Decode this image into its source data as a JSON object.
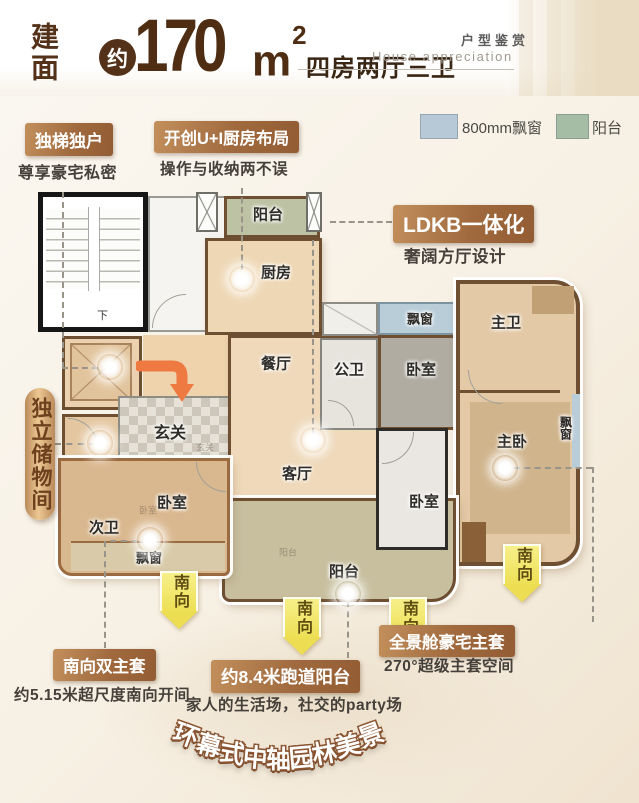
{
  "header": {
    "area_label": "建面",
    "approx": "约",
    "area_value": "170",
    "unit_base": "m",
    "unit_exp": "2",
    "layout_type": "四房两厅三卫",
    "title_cn": "户型鉴赏",
    "title_en": "House appreciation"
  },
  "legend": {
    "bay_window": {
      "label": "800mm飘窗",
      "color": "#b7c9d6"
    },
    "balcony": {
      "label": "阳台",
      "color": "#a6bda5"
    }
  },
  "callouts": {
    "private_elevator": {
      "title": "独梯独户",
      "subtitle": "尊享豪宅私密"
    },
    "kitchen_layout": {
      "title": "开创U+I厨房布局",
      "subtitle": "操作与收纳两不误"
    },
    "ldkb": {
      "title": "LDKB一体化",
      "subtitle": "奢阔方厅设计"
    },
    "storage_ribbon": "独立储物间",
    "south_double_suite": {
      "title": "南向双主套",
      "subtitle": "约5.15米超尺度南向开间"
    },
    "runway_balcony": {
      "title": "约8.4米跑道阳台",
      "subtitle": "家人的生活场，社交的party场"
    },
    "panorama_suite": {
      "title": "全景舱豪宅主套",
      "subtitle": "270°超级主套空间"
    },
    "arc_text": "环幕式中轴园林美景"
  },
  "rooms": {
    "balcony_top": "阳台",
    "kitchen": "厨房",
    "dining": "餐厅",
    "living": "客厅",
    "foyer": "玄关",
    "foyer_small": "玄关",
    "public_bath": "公卫",
    "bay_mid": "飘窗",
    "bedroom_north": "卧室",
    "master_bath": "主卫",
    "master_bedroom": "主卧",
    "bay_right": "飘窗",
    "bedroom_left": "卧室",
    "bedroom_left_wm": "卧室",
    "second_bath": "次卫",
    "bay_left": "飘窗",
    "bedroom_center": "卧室",
    "balcony_bottom": "阳台",
    "balcony_bottom_wm": "阳台",
    "stairs_down": "下"
  },
  "labels": {
    "south": "南向"
  },
  "colors": {
    "title_brown": "#4e2d13",
    "badge_light": "#c28f5c",
    "badge_dark": "#935c33",
    "arrow_yellow": "#f1e45e",
    "wall": "#6e4f32"
  }
}
